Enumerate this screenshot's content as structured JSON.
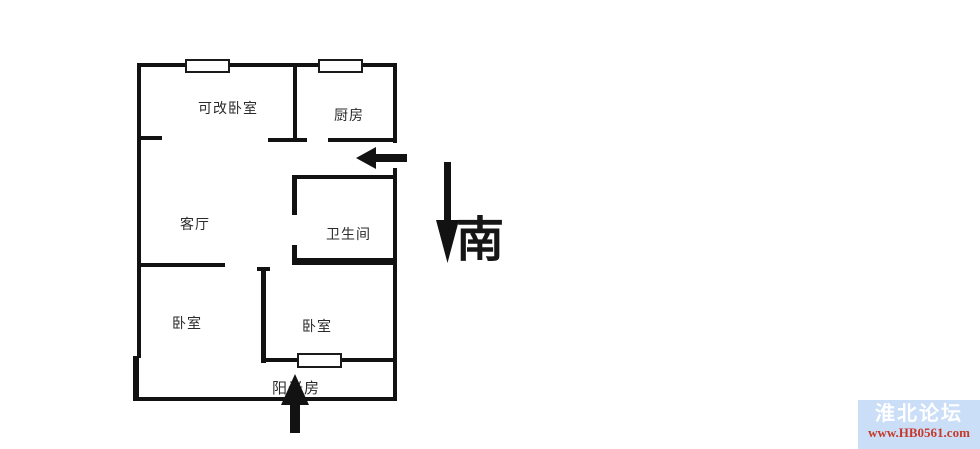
{
  "floor_plan": {
    "rooms": {
      "convertible_bedroom": "可改卧室",
      "kitchen": "厨房",
      "living_room": "客厅",
      "bathroom": "卫生间",
      "bedroom_left": "卧室",
      "bedroom_right": "卧室",
      "sunroom": "阳光房"
    },
    "compass": {
      "south_label": "南"
    },
    "colors": {
      "wall": "#121212",
      "label": "#2b2b2b"
    }
  },
  "watermark": {
    "site_name": "淮北论坛",
    "site_url": "www.HB0561.com",
    "background": "#cadef7",
    "name_color": "#ffffff",
    "url_color": "#c5392b"
  }
}
